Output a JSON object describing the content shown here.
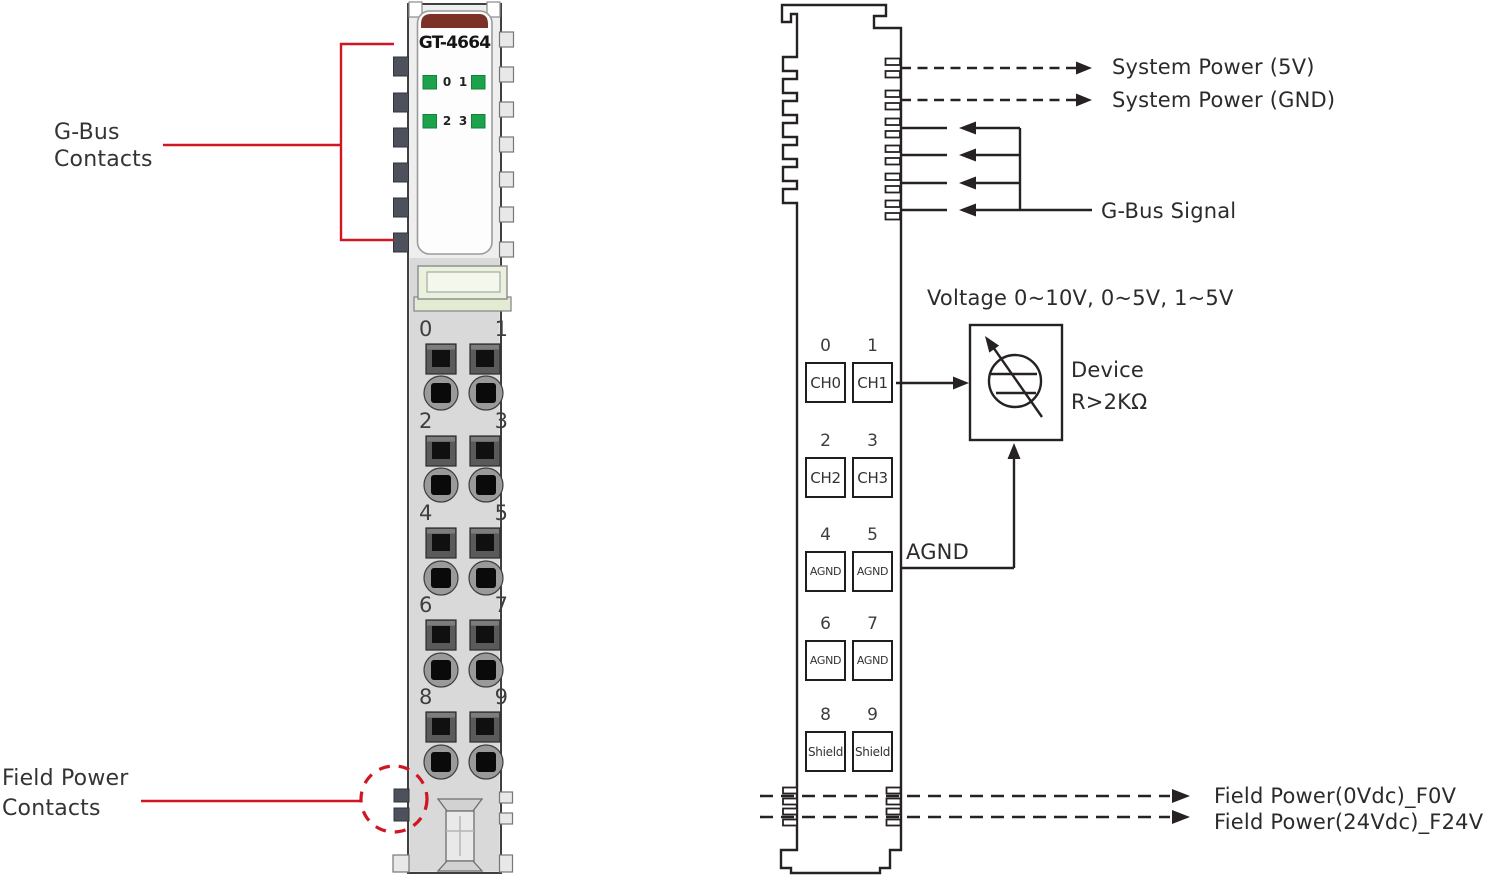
{
  "colors": {
    "annotation_red": "#d01623",
    "led_green": "#1ba24b",
    "model_band_maroon": "#7b3126",
    "line_dark": "#262223",
    "contact_tab_gray": "#4c515b"
  },
  "left_module": {
    "model": "GT-4664",
    "led_labels": [
      "0",
      "1",
      "2",
      "3"
    ],
    "terminal_numbers": [
      "0",
      "1",
      "2",
      "3",
      "4",
      "5",
      "6",
      "7",
      "8",
      "9"
    ],
    "callouts": {
      "gbus_line1": "G-Bus",
      "gbus_line2": "Contacts",
      "field_line1": "Field Power",
      "field_line2": "Contacts"
    }
  },
  "wiring_diagram": {
    "system_power_5v": "System Power (5V)",
    "system_power_gnd": "System Power (GND)",
    "gbus_signal": "G-Bus Signal",
    "voltage_range": "Voltage 0~10V, 0~5V, 1~5V",
    "device_label": "Device",
    "device_resistance": "R>2KΩ",
    "agnd_label": "AGND",
    "field_power_0v": "Field Power(0Vdc)_F0V",
    "field_power_24v": "Field Power(24Vdc)_F24V",
    "terminals": [
      {
        "num": "0",
        "label": "CH0"
      },
      {
        "num": "1",
        "label": "CH1"
      },
      {
        "num": "2",
        "label": "CH2"
      },
      {
        "num": "3",
        "label": "CH3"
      },
      {
        "num": "4",
        "label": "AGND"
      },
      {
        "num": "5",
        "label": "AGND"
      },
      {
        "num": "6",
        "label": "AGND"
      },
      {
        "num": "7",
        "label": "AGND"
      },
      {
        "num": "8",
        "label": "Shield"
      },
      {
        "num": "9",
        "label": "Shield"
      }
    ]
  }
}
